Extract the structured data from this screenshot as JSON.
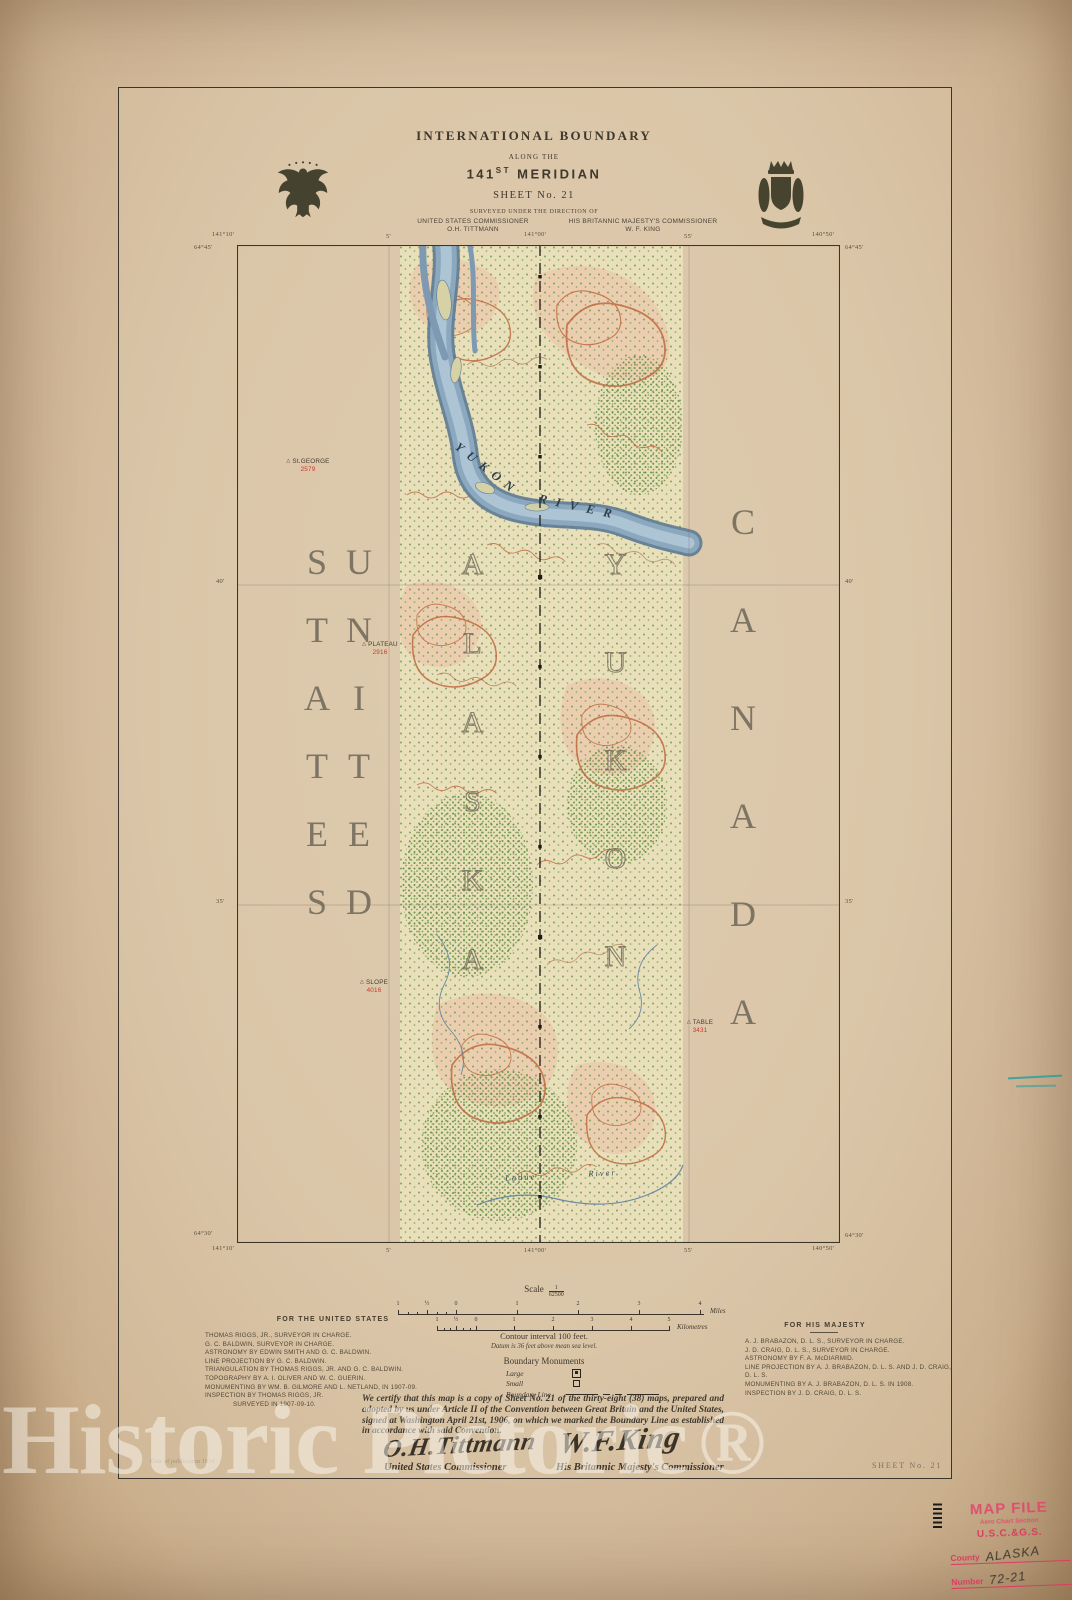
{
  "colors": {
    "paper": "#d7c1a3",
    "ink": "#3c352b",
    "stamp_red": "#dc3b60",
    "river_blue": "#8ba8bf",
    "contour_red": "#bf6a42",
    "forest_green": "#6e9a4c",
    "teal_mark": "#28a09e"
  },
  "watermark": {
    "text": "Historic Pictoric",
    "registered": "®"
  },
  "title_block": {
    "title": "INTERNATIONAL BOUNDARY",
    "subtitle": "ALONG THE",
    "meridian_number": "141",
    "meridian_ordinal": "ST",
    "meridian_word": " MERIDIAN",
    "sheet": "SHEET No. 21",
    "surveyed": "SURVEYED UNDER THE DIRECTION OF",
    "us_comm_label": "UNITED STATES COMMISSIONER",
    "us_comm_name": "O.H. TITTMANN",
    "uk_comm_label": "HIS BRITANNIC MAJESTY'S COMMISSIONER",
    "uk_comm_name": "W. F. KING"
  },
  "map": {
    "country_left": "UNITED STATES",
    "country_right": "CANADA",
    "region_left": "ALASKA",
    "region_right": "YUKON",
    "river_word_1": "YUKON",
    "river_word_2": "RIVER",
    "creek_word_1": "Ladue",
    "creek_word_2": "River",
    "stations": [
      {
        "name": "St.GEORGE",
        "elevation": "2579"
      },
      {
        "name": "PLATEAU",
        "elevation": "2916"
      },
      {
        "name": "SLOPE",
        "elevation": "4016"
      },
      {
        "name": "TABLE",
        "elevation": "3431"
      }
    ],
    "graticule": {
      "top_left_lon": "141°10'",
      "top_left_lat": "64°45'",
      "top_ticks": [
        "5'",
        "141°00'",
        "55'"
      ],
      "top_right_lon": "140°50'",
      "top_right_lat": "64°45'",
      "left_ticks": [
        "40'",
        "35'"
      ],
      "right_ticks": [
        "40'",
        "35'"
      ],
      "bottom_left_lat": "64°30'",
      "bottom_left_lon": "141°10'",
      "bottom_ticks": [
        "5'",
        "141°00'",
        "55'"
      ],
      "bottom_right_lon": "140°50'",
      "bottom_right_lat": "64°30'"
    }
  },
  "scale_block": {
    "scale_label": "Scale",
    "scale_numerator": "1",
    "scale_denominator": "62500",
    "miles_ticks": [
      "1",
      "½",
      "0",
      "1",
      "2",
      "3",
      "4"
    ],
    "miles_unit": "Miles",
    "km_ticks": [
      "1",
      "½",
      "0",
      "1",
      "2",
      "3",
      "4",
      "5"
    ],
    "km_unit": "Kilometres",
    "contour": "Contour interval 100 feet.",
    "datum": "Datum is 36 feet above mean sea level.",
    "legend_title": "Boundary Monuments",
    "legend_large": "Large",
    "legend_small": "Small",
    "legend_line": "Boundary Line"
  },
  "credits_us": {
    "heading": "FOR THE UNITED STATES",
    "lines": [
      "THOMAS RIGGS, JR., SURVEYOR IN CHARGE.",
      "G. C. BALDWIN, SURVEYOR IN CHARGE.",
      "ASTRONOMY BY EDWIN SMITH AND G. C. BALDWIN.",
      "LINE PROJECTION BY G. C. BALDWIN.",
      "TRIANGULATION BY THOMAS RIGGS, JR. AND G. C. BALDWIN.",
      "TOPOGRAPHY BY A. I. OLIVER AND W. C. GUERIN.",
      "MONUMENTING BY WM. B. GILMORE AND L. NETLAND, IN 1907-09.",
      "INSPECTION BY THOMAS RIGGS, JR.",
      "SURVEYED IN 1907-09-10."
    ]
  },
  "credits_uk": {
    "heading": "FOR HIS MAJESTY",
    "lines": [
      "A. J. BRABAZON, D. L. S., SURVEYOR IN CHARGE.",
      "J. D. CRAIG, D. L. S., SURVEYOR IN CHARGE.",
      "ASTRONOMY BY F. A. McDIARMID.",
      "LINE PROJECTION BY A. J. BRABAZON, D. L. S. AND J. D. CRAIG, D. L. S.",
      "MONUMENTING BY A. J. BRABAZON, D. L. S. IN 1908.",
      "INSPECTION BY J. D. CRAIG, D. L. S."
    ]
  },
  "certification": {
    "text": "We certify that this map is a copy of Sheet No. 21 of the thirty-eight (38) maps, prepared and adopted by us under Article II of the Convention between Great Britain and the United States, signed at Washington April 21st, 1906, on which we marked the Boundary Line as established in accordance with said Convention.",
    "us_signature": "O.H.Tittmann",
    "us_signature_title": "United States Commissioner",
    "uk_signature": "W.F.King",
    "uk_signature_title": "His Britannic Majesty's Commissioner"
  },
  "footer": {
    "publication": "Date of publication 1914",
    "sheet_no": "SHEET No. 21"
  },
  "stamp": {
    "line1": "MAP FILE",
    "line2": "Aero Chart Section",
    "line3": "U.S.C.&G.S.",
    "county_label": "County",
    "county_value": "ALASKA",
    "number_label": "Number",
    "number_value": "72-21"
  }
}
